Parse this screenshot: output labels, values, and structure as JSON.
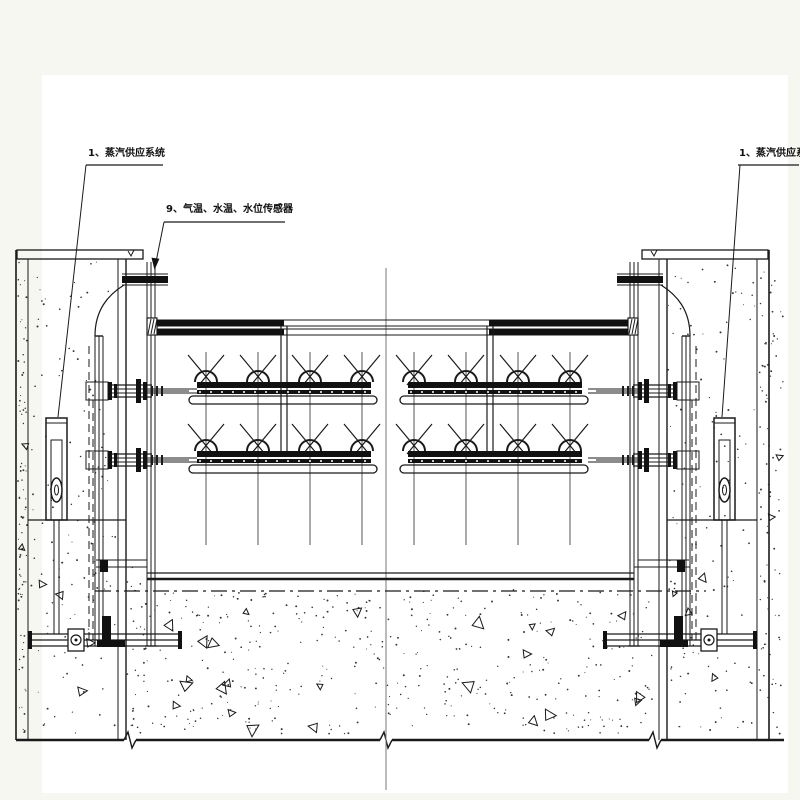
{
  "drawing": {
    "callouts": {
      "steam_supply_left": "1、蒸汽供应系统",
      "sensors": "9、气温、水温、水位传感器",
      "steam_supply_right": "1、蒸汽供应系统"
    },
    "colors": {
      "paper": "#ffffff",
      "margin": "#f5f7f0",
      "line": "#1a1a1a",
      "centerline": "#777777"
    }
  }
}
